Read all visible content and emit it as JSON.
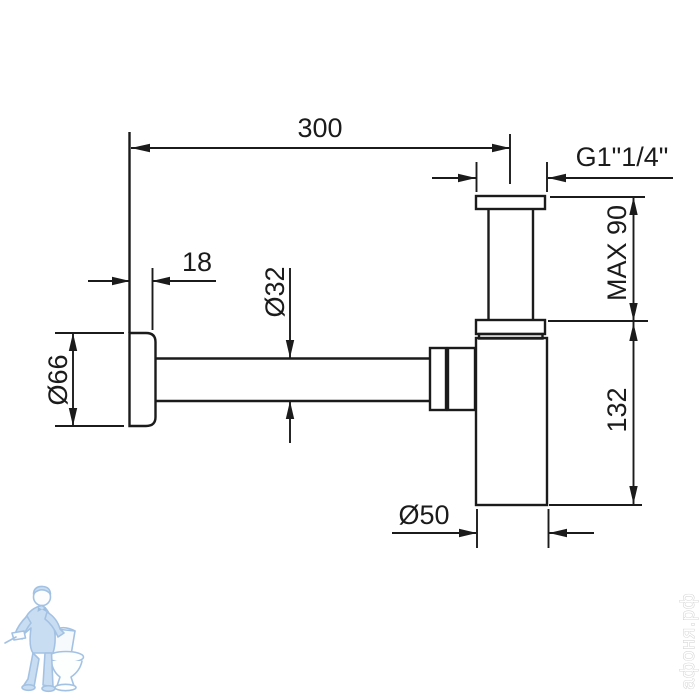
{
  "drawing": {
    "type": "technical-diagram",
    "subject": "bottle-trap-siphon",
    "line_color": "#1b1b1b",
    "dimensions": {
      "reach": "300",
      "thread": "G1\"1/4\"",
      "flange_depth": "18",
      "pipe_diameter": "Ø32",
      "flange_diameter": "Ø66",
      "max_inlet": "MAX 90",
      "body_height": "132",
      "body_diameter": "Ø50"
    }
  },
  "watermark": {
    "site": "афоня.рф",
    "logo": "plumber-with-toilet",
    "logo_color": "#a3c2e3",
    "logo_fill": "#c9ddf2",
    "text_color": "#cccccc"
  }
}
